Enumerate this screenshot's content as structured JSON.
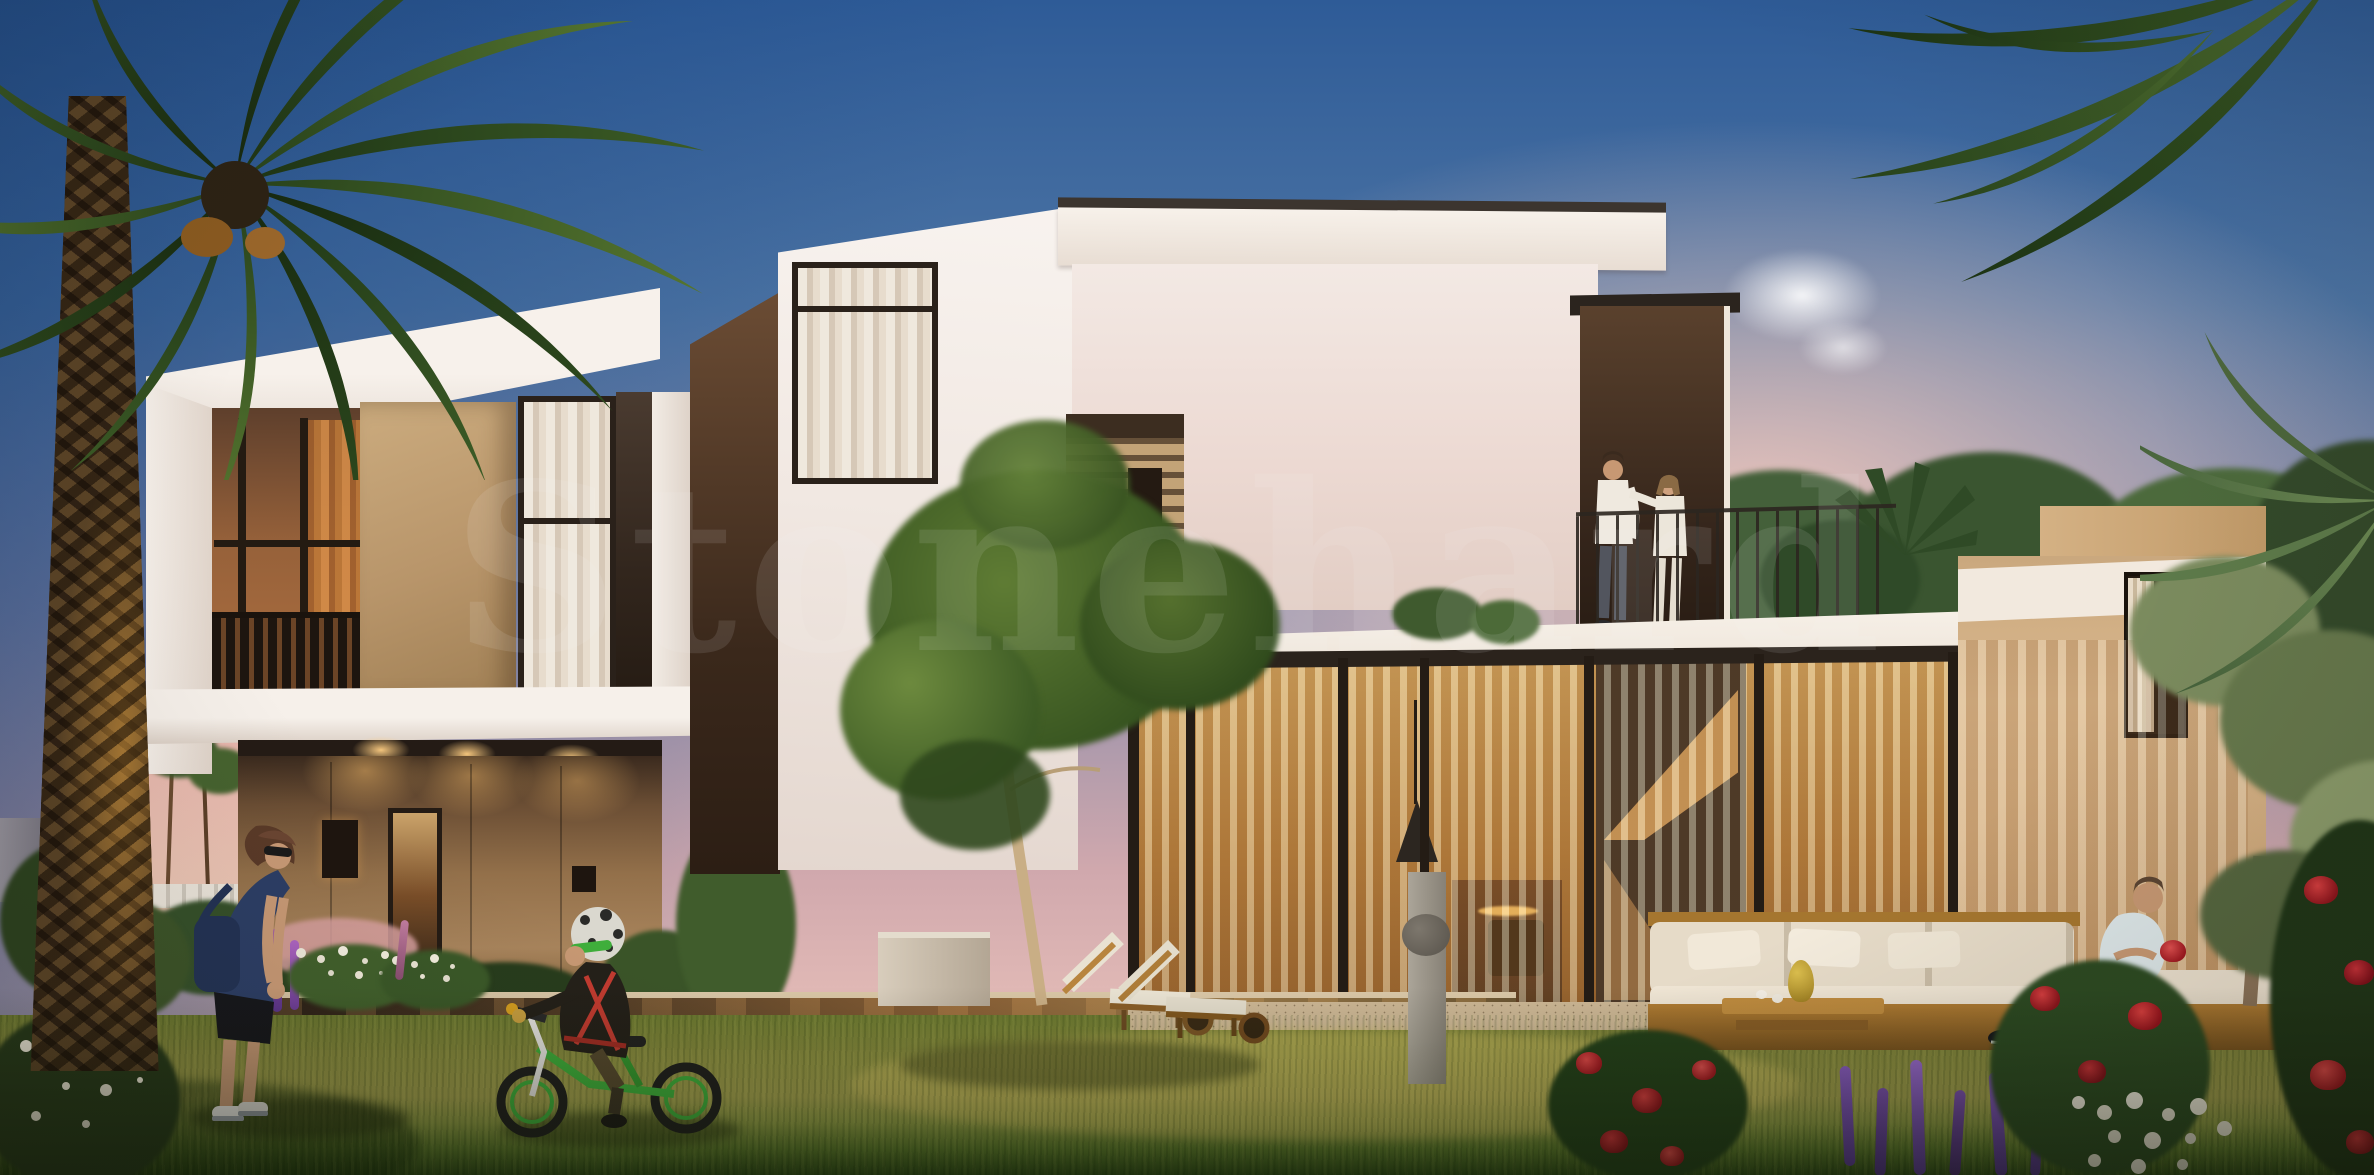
{
  "image": {
    "watermark": {
      "text": "Stonehard"
    },
    "palette": {
      "sky_top": "#2e5b97",
      "sky_horizon": "#f2cabe",
      "facade_white": "#f4eeea",
      "stucco_sand": "#c0a178",
      "stucco_bronze": "#7c5b3c",
      "window_frame": "#2a211a",
      "interior_glow": "#e2a050",
      "lawn_green": "#8f9142",
      "palm_green": "#33511f",
      "rose_red": "#b6202a",
      "salvia_purple": "#6f49a8",
      "pool_reflection": "#5f452a"
    }
  }
}
